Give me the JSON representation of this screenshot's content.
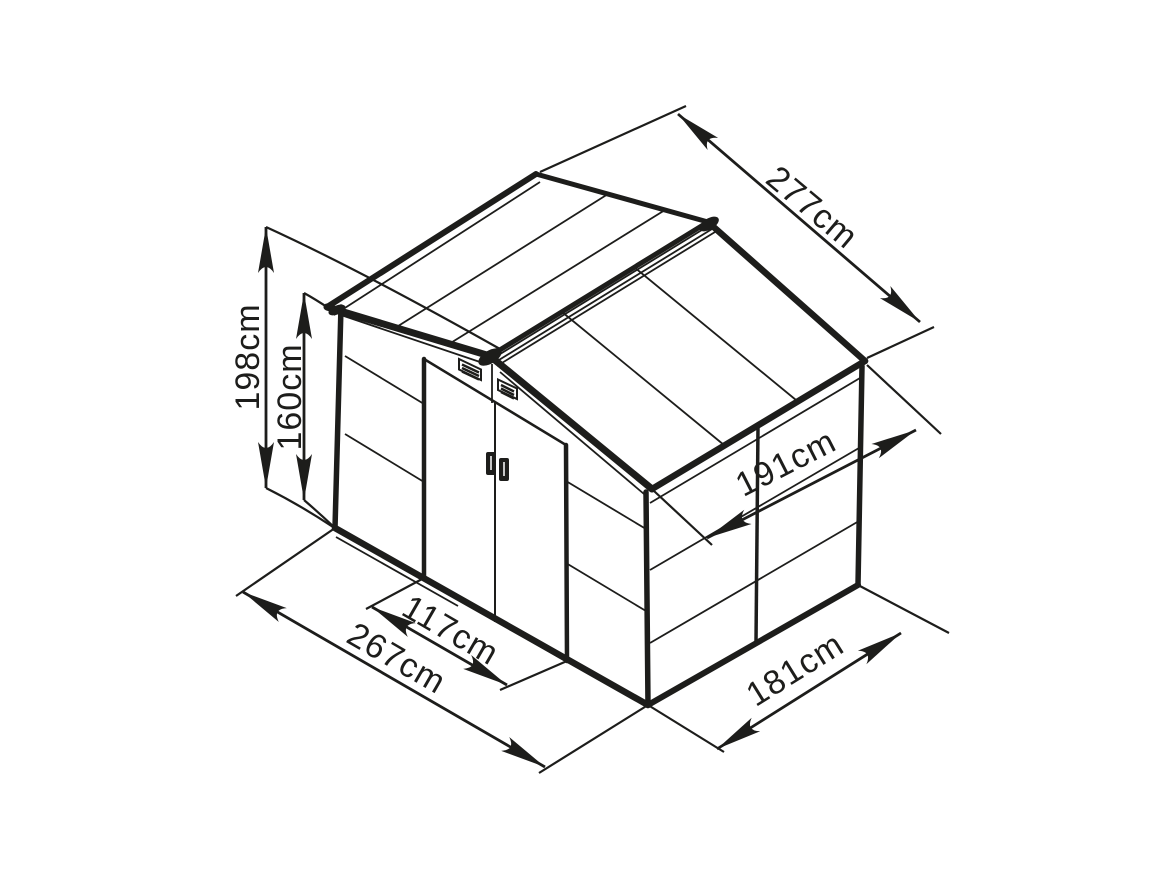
{
  "colors": {
    "line": "#1d1d1b",
    "background": "#ffffff"
  },
  "dimensions": {
    "total_height": "198cm",
    "eaves_height": "160cm",
    "roof_length": "277cm",
    "roof_depth": "191cm",
    "door_width": "117cm",
    "base_width": "267cm",
    "base_depth": "181cm"
  }
}
